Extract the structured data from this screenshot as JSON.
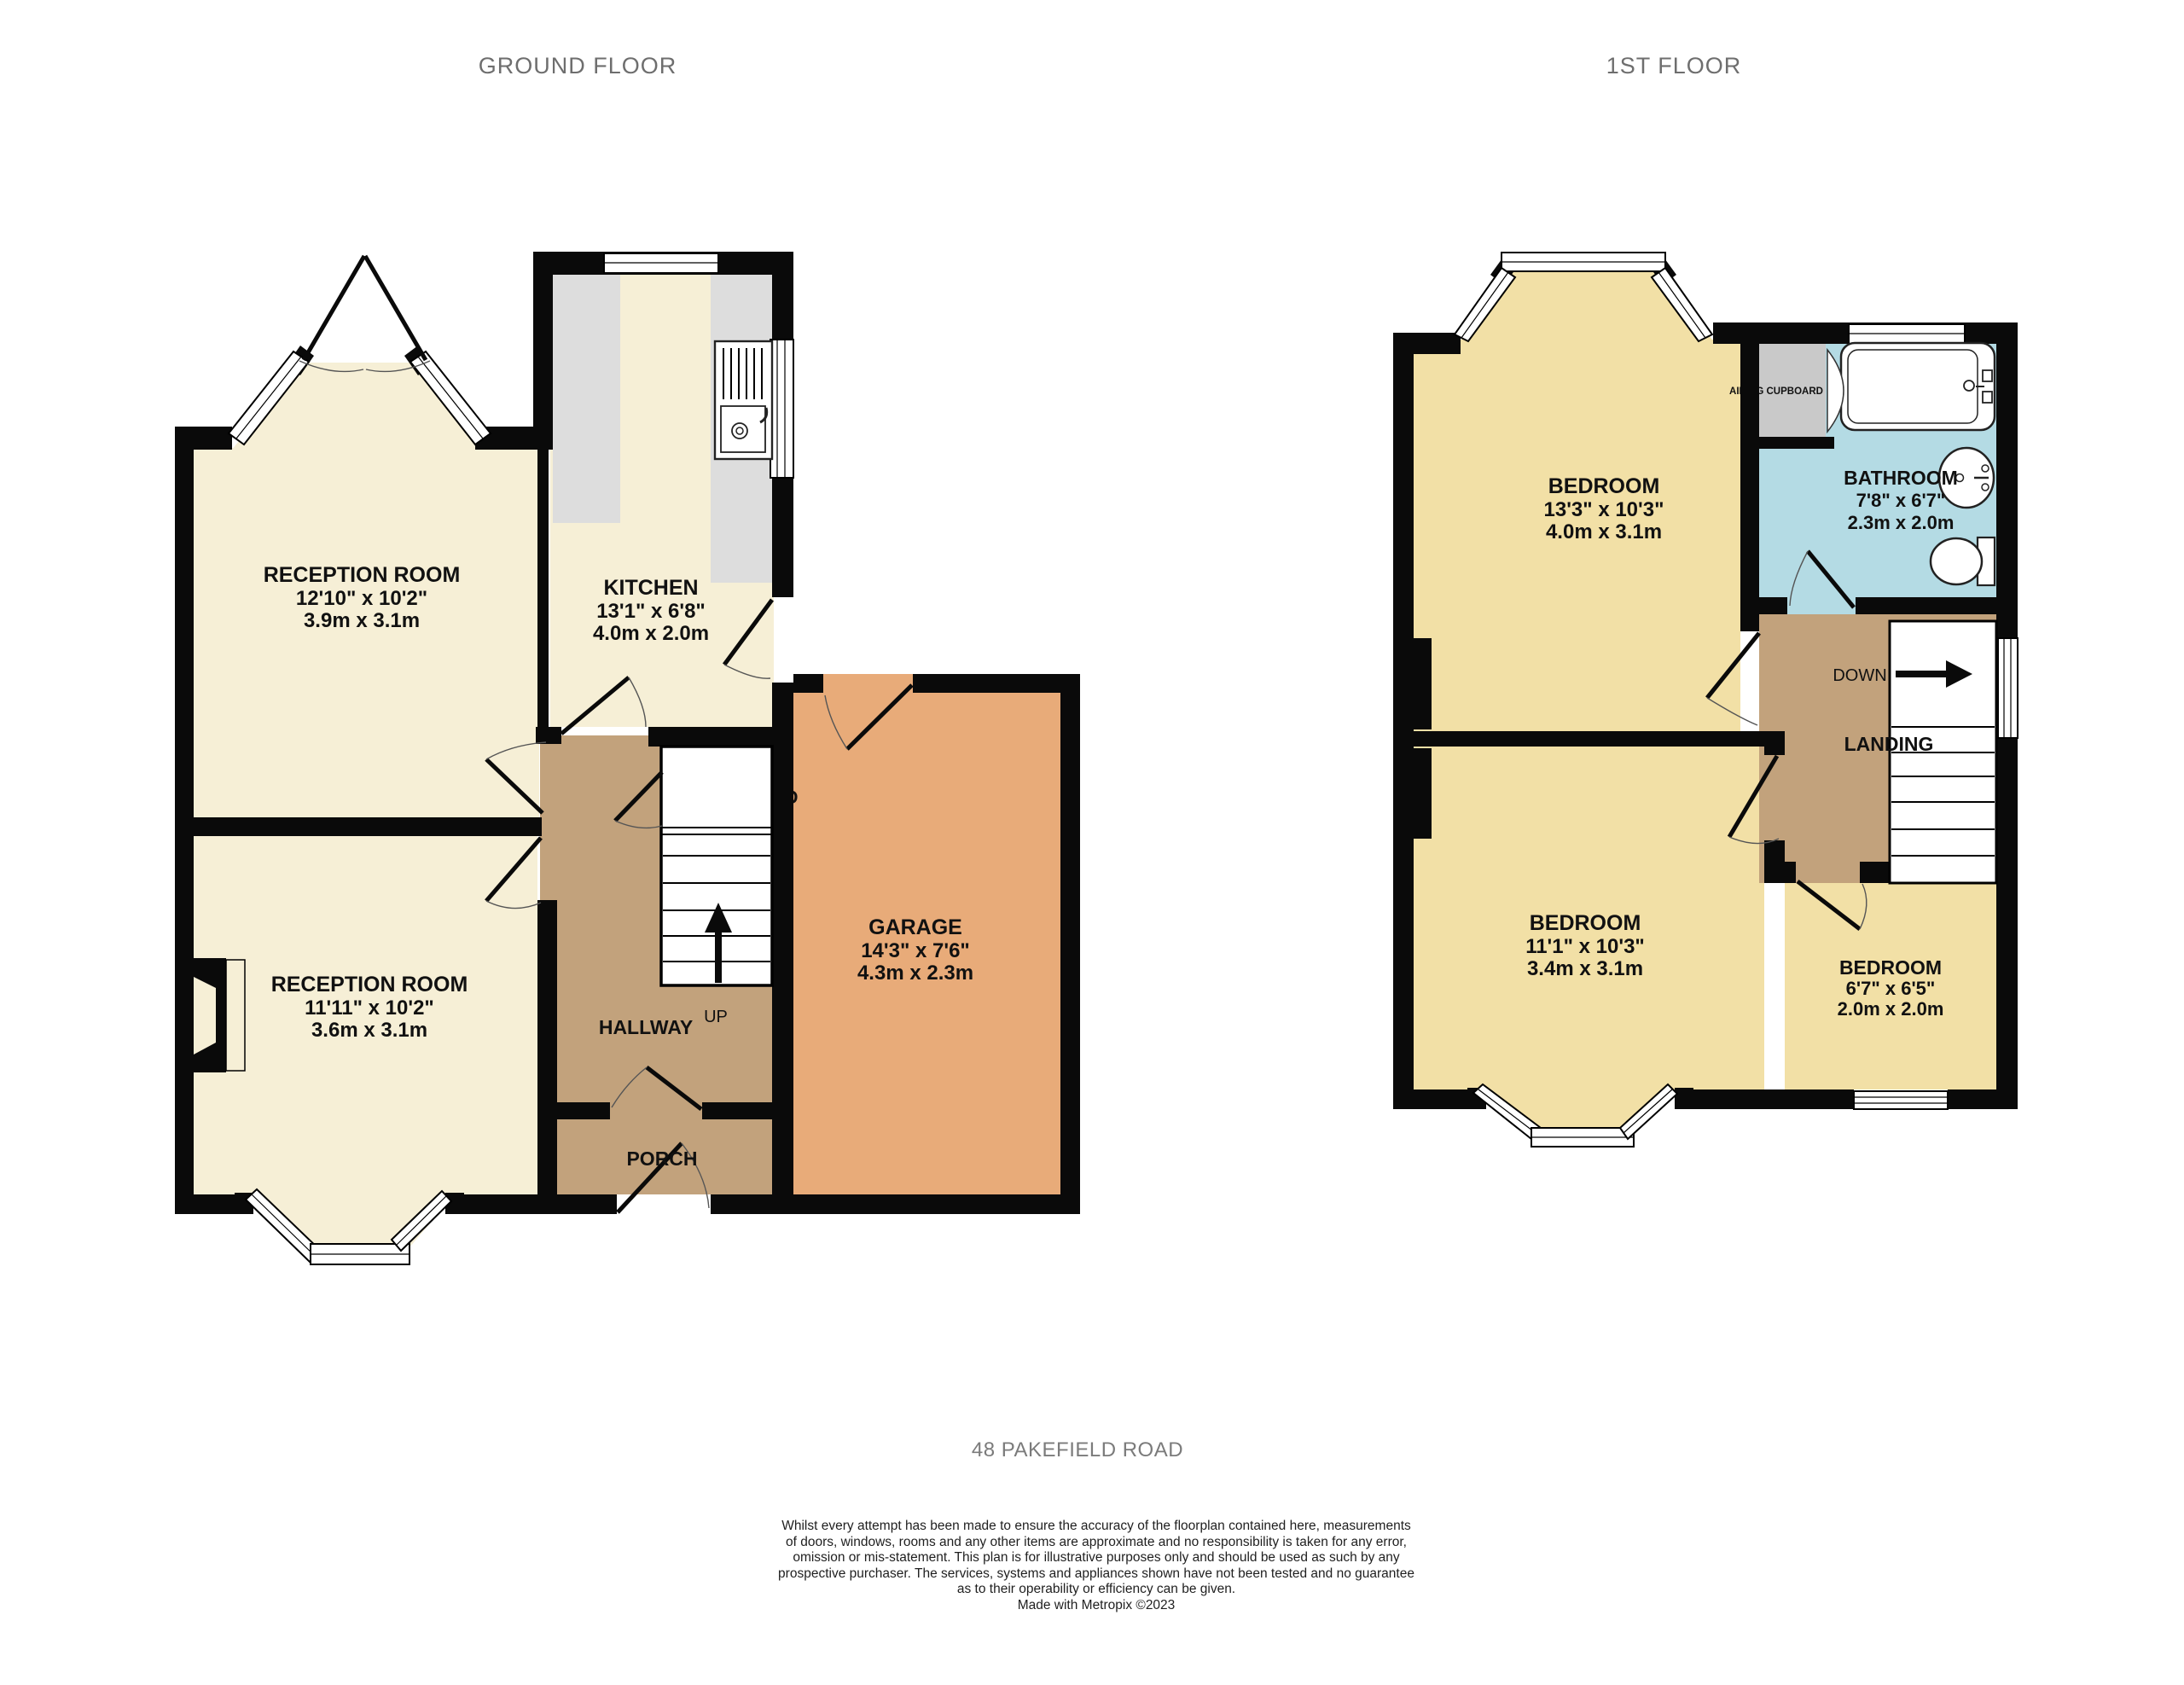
{
  "titles": {
    "ground": "GROUND FLOOR",
    "first": "1ST FLOOR"
  },
  "colors": {
    "wall": "#0a0a0a",
    "cream": "#f6efd6",
    "bedroom_yellow": "#f2e0a6",
    "hall_tan": "#c2a27c",
    "garage_orange": "#e8ab79",
    "bathroom_blue": "#b4dbe4",
    "counter_gray": "#dddddd",
    "cupboard_gray": "#c9c9c9"
  },
  "ground": {
    "reception1": {
      "name": "RECEPTION ROOM",
      "imperial": "12'10\" x 10'2\"",
      "metric": "3.9m x 3.1m"
    },
    "reception2": {
      "name": "RECEPTION ROOM",
      "imperial": "11'11\" x 10'2\"",
      "metric": "3.6m x 3.1m"
    },
    "kitchen": {
      "name": "KITCHEN",
      "imperial": "13'1\" x 6'8\"",
      "metric": "4.0m x 2.0m"
    },
    "garage": {
      "name": "GARAGE",
      "imperial": "14'3\" x 7'6\"",
      "metric": "4.3m x 2.3m"
    },
    "hallway": {
      "name": "HALLWAY"
    },
    "porch": {
      "name": "PORCH"
    },
    "cupboard": {
      "name": "CUPBOARD"
    },
    "stairs_up": "UP"
  },
  "first": {
    "bedroom1": {
      "name": "BEDROOM",
      "imperial": "13'3\" x 10'3\"",
      "metric": "4.0m x 3.1m"
    },
    "bedroom2": {
      "name": "BEDROOM",
      "imperial": "11'1\" x 10'3\"",
      "metric": "3.4m x 3.1m"
    },
    "bedroom3": {
      "name": "BEDROOM",
      "imperial": "6'7\" x 6'5\"",
      "metric": "2.0m x 2.0m"
    },
    "bathroom": {
      "name": "BATHROOM",
      "imperial": "7'8\" x 6'7\"",
      "metric": "2.3m x 2.0m"
    },
    "landing": {
      "name": "LANDING"
    },
    "airing_cupboard": {
      "name": "AIRING CUPBOARD"
    },
    "stairs_down": "DOWN"
  },
  "footer": {
    "address": "48 PAKEFIELD ROAD",
    "disclaimer_lines": [
      "Whilst every attempt has been made to ensure the accuracy of the floorplan contained here, measurements",
      "of doors, windows, rooms and any other items are approximate and no responsibility is taken for any error,",
      "omission or mis-statement. This plan is for illustrative purposes only and should be used as such by any",
      "prospective purchaser. The services, systems and appliances shown have not been tested and no guarantee",
      "as to their operability or efficiency can be given.",
      "Made with Metropix ©2023"
    ]
  }
}
